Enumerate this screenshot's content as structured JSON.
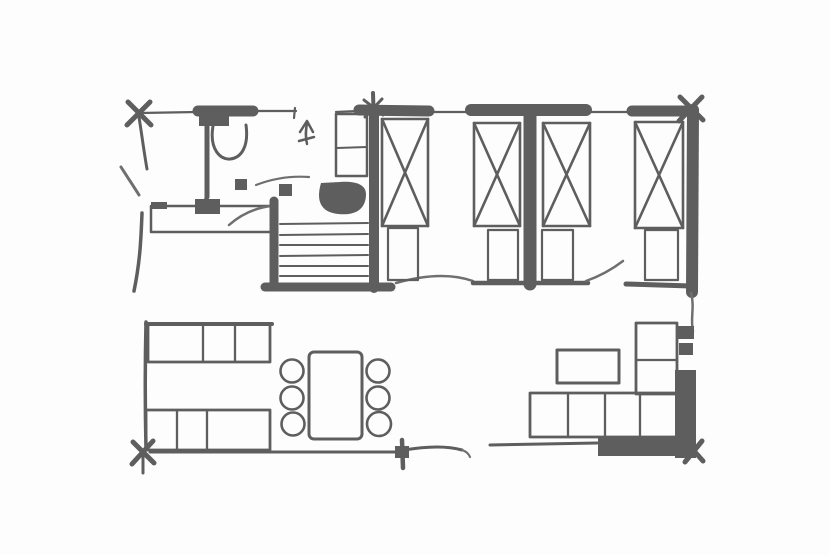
{
  "title": "Hand-drawn floor plan sketch",
  "canvas": {
    "width": 830,
    "height": 555
  },
  "colors": {
    "ink": "#5e5e5e",
    "ink_soft": "#6f6f6f",
    "background": "#fdfdfd"
  },
  "drawing": {
    "style": "freehand ink floor plan, no text labels visible",
    "rooms": [
      {
        "name": "bathroom",
        "items": [
          "toilet",
          "vanity-sink",
          "door-swing-arc"
        ]
      },
      {
        "name": "hallway",
        "items": [
          "staircase-6-treads",
          "up-direction-arrow",
          "closet-cabinet",
          "wash-basin"
        ]
      },
      {
        "name": "bedroom-left",
        "items": [
          "bed-x-mattress",
          "bed-x-mattress",
          "foot-locker",
          "foot-locker"
        ]
      },
      {
        "name": "bedroom-right",
        "items": [
          "bed-x-mattress",
          "bed-x-mattress",
          "foot-locker",
          "foot-locker"
        ]
      },
      {
        "name": "living-dining",
        "items": [
          "three-seat-sofa",
          "three-seat-sofa",
          "dining-table",
          "chair",
          "chair",
          "chair",
          "chair",
          "chair",
          "chair"
        ]
      },
      {
        "name": "lounge-corner",
        "items": [
          "l-shaped-corner-sofa",
          "coffee-table"
        ]
      }
    ],
    "counts": {
      "beds": 4,
      "dining_chairs": 6,
      "stair_treads": 6,
      "sofas": 3,
      "corner_posts": 4
    }
  }
}
